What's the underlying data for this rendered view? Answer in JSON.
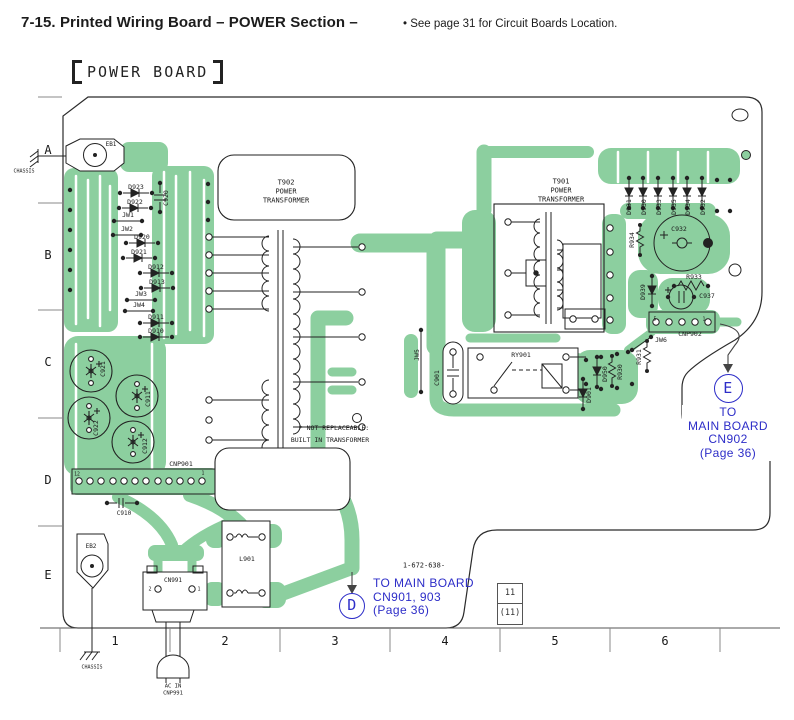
{
  "header": {
    "title": "7-15. Printed Wiring Board – POWER Section –",
    "note": "• See page 31 for Circuit Boards Location."
  },
  "board_title": "POWER BOARD",
  "part_number": "1-672-638-",
  "page_ref": {
    "top": "11",
    "bottom": "(11)"
  },
  "annotations": {
    "d": {
      "ref": "D",
      "lines": [
        "TO MAIN BOARD",
        "CN901, 903",
        "(Page 36)"
      ]
    },
    "e": {
      "ref": "E",
      "lines": [
        "TO",
        "MAIN BOARD",
        "CN902",
        "(Page 36)"
      ]
    }
  },
  "colors": {
    "trace_green": "#8ccf9f",
    "annotation_blue": "#2d2dc8",
    "ink": "#1c1c1c"
  },
  "labels": [
    {
      "t": "EB1",
      "x": 111,
      "y": 145,
      "s": 6
    },
    {
      "t": "CHASSIS",
      "x": 24,
      "y": 172,
      "s": 5
    },
    {
      "t": "D923",
      "x": 136,
      "y": 187,
      "s": 6.5
    },
    {
      "t": "D922",
      "x": 135,
      "y": 202,
      "s": 6.5
    },
    {
      "t": "JW1",
      "x": 128,
      "y": 215,
      "s": 6.5
    },
    {
      "t": "JW2",
      "x": 127,
      "y": 229,
      "s": 6.5
    },
    {
      "t": "D920",
      "x": 142,
      "y": 237,
      "s": 6.5
    },
    {
      "t": "D921",
      "x": 139,
      "y": 252,
      "s": 6.5
    },
    {
      "t": "C920",
      "x": 166,
      "y": 198,
      "r": -90,
      "s": 6.5
    },
    {
      "t": "D912",
      "x": 156,
      "y": 267,
      "s": 6.5
    },
    {
      "t": "D913",
      "x": 157,
      "y": 282,
      "s": 6.5
    },
    {
      "t": "JW3",
      "x": 141,
      "y": 294,
      "s": 6.5
    },
    {
      "t": "JW4",
      "x": 139,
      "y": 305,
      "s": 6.5
    },
    {
      "t": "D911",
      "x": 156,
      "y": 317,
      "s": 6.5
    },
    {
      "t": "D910",
      "x": 156,
      "y": 331,
      "s": 6.5
    },
    {
      "t": "C921",
      "x": 103,
      "y": 369,
      "r": -90,
      "s": 6.5
    },
    {
      "t": "C911",
      "x": 148,
      "y": 399,
      "r": -90,
      "s": 6.5
    },
    {
      "t": "C922",
      "x": 96,
      "y": 428,
      "r": -90,
      "s": 6.5
    },
    {
      "t": "C912",
      "x": 145,
      "y": 446,
      "r": -90,
      "s": 6.5
    },
    {
      "t": "CNP901",
      "x": 181,
      "y": 464,
      "s": 6.5
    },
    {
      "t": "12",
      "x": 77,
      "y": 476,
      "s": 4.8
    },
    {
      "t": "1",
      "x": 203,
      "y": 475,
      "s": 4.8
    },
    {
      "t": "C910",
      "x": 124,
      "y": 514,
      "s": 6
    },
    {
      "t": "EB2",
      "x": 91,
      "y": 547,
      "s": 6
    },
    {
      "t": "CHASSIS",
      "x": 92,
      "y": 668,
      "s": 5
    },
    {
      "t": "CN991",
      "x": 173,
      "y": 581,
      "s": 6
    },
    {
      "t": "2",
      "x": 150,
      "y": 590,
      "s": 5
    },
    {
      "t": "1",
      "x": 199,
      "y": 590,
      "s": 5
    },
    {
      "t": "AC IN",
      "x": 173,
      "y": 687,
      "s": 5.5
    },
    {
      "t": "CNP991",
      "x": 173,
      "y": 694,
      "s": 5.5
    },
    {
      "t": "L901",
      "x": 247,
      "y": 559,
      "s": 6.5
    },
    {
      "t": "T902",
      "x": 286,
      "y": 183,
      "s": 7
    },
    {
      "t": "POWER",
      "x": 286,
      "y": 192,
      "s": 7
    },
    {
      "t": "TRANSFORMER",
      "x": 286,
      "y": 201,
      "s": 7
    },
    {
      "t": "T901",
      "x": 561,
      "y": 182,
      "s": 7
    },
    {
      "t": "POWER",
      "x": 561,
      "y": 191,
      "s": 7
    },
    {
      "t": "TRANSFORMER",
      "x": 561,
      "y": 200,
      "s": 7
    },
    {
      "t": "JW5",
      "x": 417,
      "y": 355,
      "r": -90,
      "s": 6.5
    },
    {
      "t": "C901",
      "x": 437,
      "y": 378,
      "r": -90,
      "s": 6.5
    },
    {
      "t": "RY901",
      "x": 521,
      "y": 355,
      "s": 6.5
    },
    {
      "t": "D901",
      "x": 589,
      "y": 395,
      "r": -90,
      "s": 6.5
    },
    {
      "t": "D950",
      "x": 605,
      "y": 374,
      "r": -90,
      "s": 6.5
    },
    {
      "t": "R930",
      "x": 620,
      "y": 372,
      "r": -90,
      "s": 6.5
    },
    {
      "t": "R931",
      "x": 639,
      "y": 357,
      "r": -90,
      "s": 6.5
    },
    {
      "t": "JW6",
      "x": 661,
      "y": 340,
      "s": 6.5
    },
    {
      "t": "CNP902",
      "x": 690,
      "y": 334,
      "s": 6.5
    },
    {
      "t": "5",
      "x": 655,
      "y": 321,
      "s": 4.8
    },
    {
      "t": "1",
      "x": 704,
      "y": 321,
      "s": 4.8
    },
    {
      "t": "D931",
      "x": 629,
      "y": 207,
      "r": -90,
      "s": 6.5
    },
    {
      "t": "D930",
      "x": 644,
      "y": 207,
      "r": -90,
      "s": 6.5
    },
    {
      "t": "D933",
      "x": 659,
      "y": 207,
      "r": -90,
      "s": 6.5
    },
    {
      "t": "D935",
      "x": 674,
      "y": 207,
      "r": -90,
      "s": 6.5
    },
    {
      "t": "D934",
      "x": 688,
      "y": 207,
      "r": -90,
      "s": 6.5
    },
    {
      "t": "D932",
      "x": 703,
      "y": 207,
      "r": -90,
      "s": 6.5
    },
    {
      "t": "C932",
      "x": 679,
      "y": 229,
      "s": 6.5
    },
    {
      "t": "R934",
      "x": 632,
      "y": 240,
      "r": -90,
      "s": 6.5
    },
    {
      "t": "R933",
      "x": 694,
      "y": 277,
      "s": 6.5
    },
    {
      "t": "D939",
      "x": 643,
      "y": 292,
      "r": -90,
      "s": 6.5
    },
    {
      "t": "C937",
      "x": 707,
      "y": 296,
      "s": 6.5
    },
    {
      "t": "* NOT REPLACEABLE:",
      "x": 334,
      "y": 428,
      "s": 6.5
    },
    {
      "t": "BUILT IN TRANSFORMER",
      "x": 330,
      "y": 440,
      "s": 6.5
    },
    {
      "t": "1-672-638-",
      "x": 424,
      "y": 566,
      "s": 7
    },
    {
      "t": "A",
      "x": 48,
      "y": 150,
      "s": 12,
      "n": "grid-row-label"
    },
    {
      "t": "B",
      "x": 48,
      "y": 255,
      "s": 12,
      "n": "grid-row-label"
    },
    {
      "t": "C",
      "x": 48,
      "y": 362,
      "s": 12,
      "n": "grid-row-label"
    },
    {
      "t": "D",
      "x": 48,
      "y": 480,
      "s": 12,
      "n": "grid-row-label"
    },
    {
      "t": "E",
      "x": 48,
      "y": 575,
      "s": 12,
      "n": "grid-row-label"
    },
    {
      "t": "1",
      "x": 115,
      "y": 641,
      "s": 12,
      "n": "grid-col-label"
    },
    {
      "t": "2",
      "x": 225,
      "y": 641,
      "s": 12,
      "n": "grid-col-label"
    },
    {
      "t": "3",
      "x": 335,
      "y": 641,
      "s": 12,
      "n": "grid-col-label"
    },
    {
      "t": "4",
      "x": 445,
      "y": 641,
      "s": 12,
      "n": "grid-col-label"
    },
    {
      "t": "5",
      "x": 555,
      "y": 641,
      "s": 12,
      "n": "grid-col-label"
    },
    {
      "t": "6",
      "x": 665,
      "y": 641,
      "s": 12,
      "n": "grid-col-label"
    }
  ]
}
